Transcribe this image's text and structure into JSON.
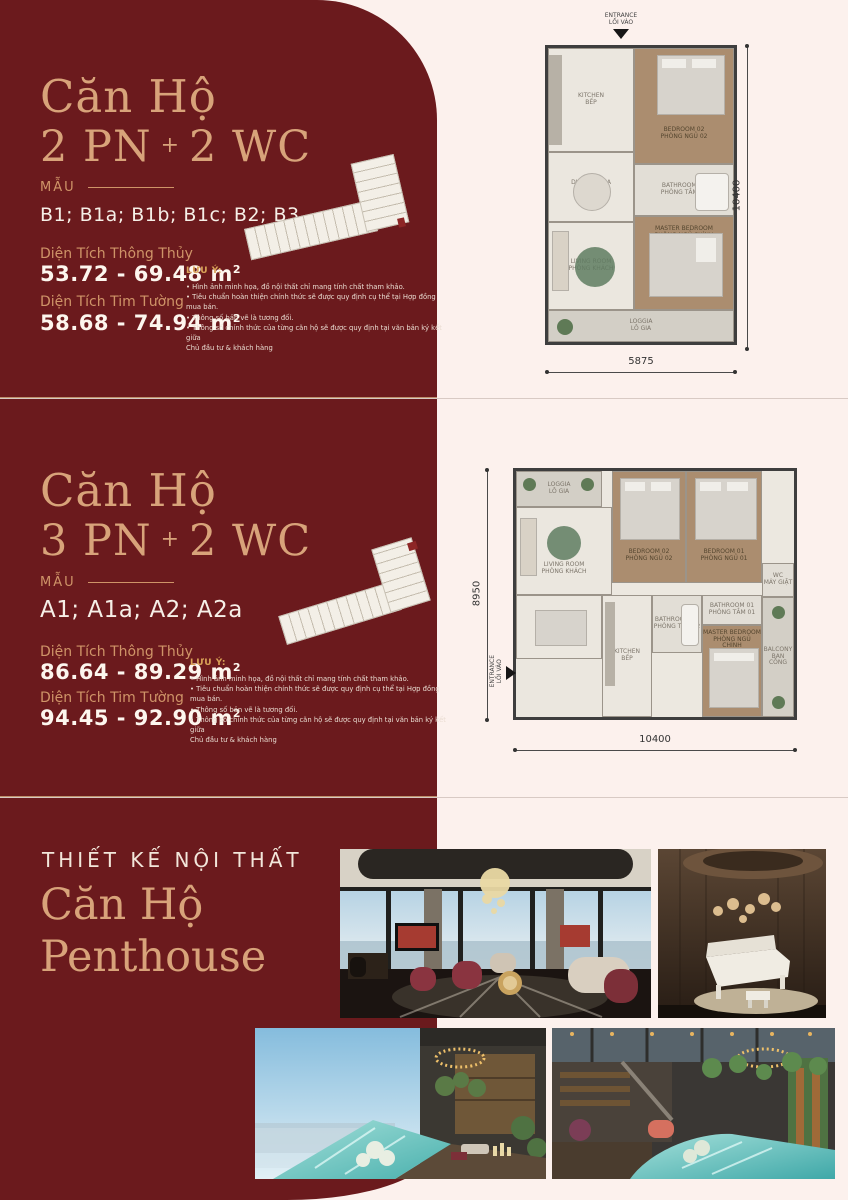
{
  "colors": {
    "accent_red": "#6b1a1d",
    "gold": "#d8a37a",
    "gold_dark": "#cf9468",
    "cream": "#f6efe7",
    "page_bg": "#fcf1ed"
  },
  "panel1": {
    "title_line1": "Căn Hộ",
    "title_line2_a": "2 PN",
    "title_plus": "+",
    "title_line2_b": "2 WC",
    "mau_label": "MẪU",
    "models": "B1; B1a; B1b; B1c; B2; B3",
    "area1_label": "Diện Tích Thông Thủy",
    "area1_value": "53.72 - 69.48",
    "area1_unit": "m",
    "area1_sup": "2",
    "area2_label": "Diện Tích Tim Tường",
    "area2_value": "58.68 - 74.94",
    "area2_unit": "m",
    "area2_sup": "2",
    "notes": {
      "heading": "LƯU Ý:",
      "items": [
        "• Hình ảnh minh họa, đồ nội thất chỉ mang tính chất tham khảo.",
        "• Tiêu chuẩn hoàn thiện chính thức sẽ được quy định cụ thể tại Hợp đồng mua bán.",
        "• Thông số bản vẽ là tương đối.",
        "• Thông số chính thức của từng căn hộ sẽ được quy định tại văn bản ký kết giữa\nChủ đầu tư & khách hàng"
      ]
    },
    "plan": {
      "entrance_label": "ENTRANCE\nLỐI VÀO",
      "dim_bottom": "5875",
      "dim_right": "10400",
      "rooms": {
        "kitchen": "KITCHEN\nBẾP",
        "bedroom2": "BEDROOM 02\nPHÒNG NGỦ 02",
        "bathroom2": "BATHROOM 02\nPHÒNG TẮM 02",
        "dining": "DINING AREA\nBÀN ĂN",
        "living": "LIVING ROOM\nPHÒNG KHÁCH",
        "master": "MASTER BEDROOM\nPHÒNG NGỦ CHÍNH",
        "loggia": "LOGGIA\nLÔ GIA"
      }
    }
  },
  "panel2": {
    "title_line1": "Căn Hộ",
    "title_line2_a": "3 PN",
    "title_plus": "+",
    "title_line2_b": "2 WC",
    "mau_label": "MẪU",
    "models": "A1; A1a; A2; A2a",
    "area1_label": "Diện Tích Thông Thủy",
    "area1_value": "86.64  - 89.29",
    "area1_unit": "m",
    "area1_sup": "2",
    "area2_label": "Diện Tích Tim Tường",
    "area2_value": "94.45 - 92.90",
    "area2_unit": "m",
    "area2_sup": "2",
    "notes": {
      "heading": "LƯU Ý:",
      "items": [
        "• Hình ảnh minh họa, đồ nội thất chỉ mang tính chất tham khảo.",
        "• Tiêu chuẩn hoàn thiện chính thức sẽ được quy định cụ thể tại Hợp đồng mua bán.",
        "• Thông số bản vẽ là tương đối.",
        "• Thông số chính thức của từng căn hộ sẽ được quy định tại văn bản ký kết giữa\nChủ đầu tư & khách hàng"
      ]
    },
    "plan": {
      "entrance_label": "ENTRANCE\nLỐI VÀO",
      "dim_left": "8950",
      "dim_bottom": "10400",
      "rooms": {
        "loggia": "LOGGIA\nLÔ GIA",
        "living": "LIVING ROOM\nPHÒNG KHÁCH",
        "bedroom2": "BEDROOM 02\nPHÒNG NGỦ 02",
        "bedroom1": "BEDROOM 01\nPHÒNG NGỦ 01",
        "utility": "WC\nMÁY GIẶT",
        "dining": "DINING AREA\nBÀN ĂN",
        "kitchen": "KITCHEN\nBẾP",
        "bathroom2": "BATHROOM 02\nPHÒNG TẮM 02",
        "bathroom1": "BATHROOM 01\nPHÒNG TẮM 01",
        "master": "MASTER BEDROOM\nPHÒNG NGỦ CHÍNH",
        "balcony": "BALCONY\nBAN CÔNG"
      }
    }
  },
  "panel3": {
    "subtitle": "THIẾT KẾ NỘI THẤT",
    "title1": "Căn Hộ",
    "title2": "Penthouse"
  }
}
